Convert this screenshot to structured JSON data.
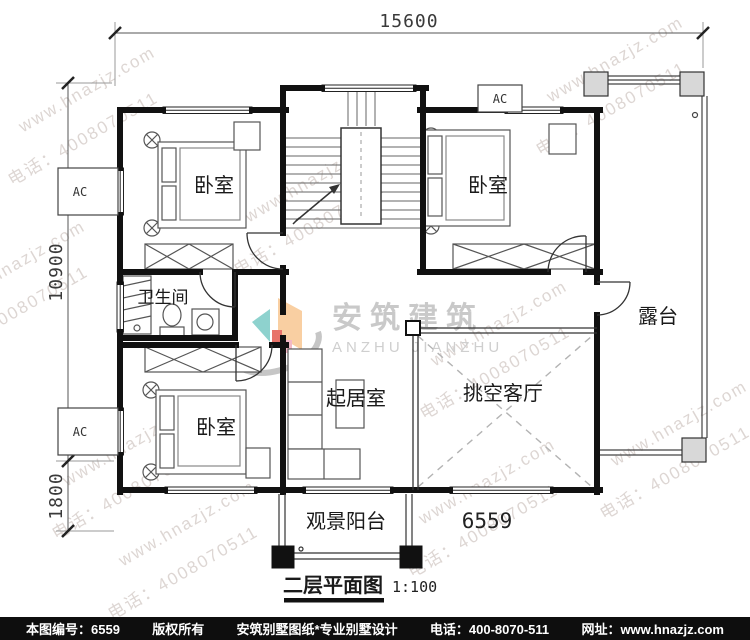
{
  "drawing": {
    "title": "二层平面图",
    "scale": "1:100",
    "plan_number": "6559"
  },
  "dimensions": {
    "total_width": "15600",
    "main_depth": "10900",
    "balcony_depth": "1800"
  },
  "rooms": {
    "bedroom": "卧室",
    "bathroom": "卫生间",
    "living_room": "起居室",
    "double_height_living_room": "挑空客厅",
    "terrace": "露台",
    "view_balcony": "观景阳台"
  },
  "equipment": {
    "ac": "AC"
  },
  "logo": {
    "cn": "安筑建筑",
    "en": "ANZHU JIANZHU"
  },
  "watermark": {
    "site": "www.hnazjz.com",
    "phone": "电话：4008070511"
  },
  "footer": {
    "plan_no": "本图编号：6559",
    "copyright": "版权所有",
    "brand": "安筑别墅图纸*专业别墅设计",
    "phone": "电话：400-8070-511",
    "website": "网址：www.hnazjz.com"
  },
  "colors": {
    "wall": "#111111",
    "thin_line": "#333333",
    "dim_line": "#444444",
    "watermark": "#ddd6d3",
    "logo_text": "#c9c9c9",
    "footer_bg": "#0e0e0e",
    "footer_text": "#ffffff",
    "accent_orange": "#f9cfa2",
    "accent_teal": "#8ed2ce",
    "accent_red": "#e8736a",
    "accent_pink": "#f2b8c6",
    "swoosh_gray": "#c6c6c6"
  }
}
